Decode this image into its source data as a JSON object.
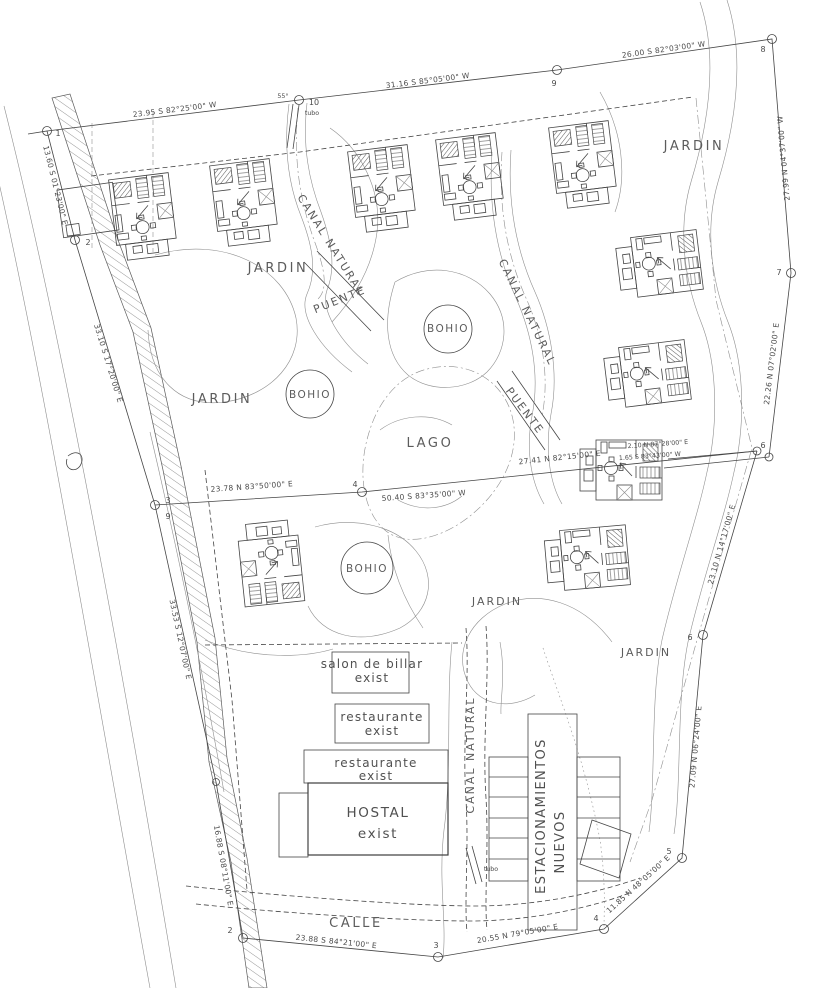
{
  "colors": {
    "background": "#ffffff",
    "line": "#454545",
    "text": "#4f4f4f"
  },
  "areas": {
    "jardin": "JARDIN",
    "bohio": "BOHIO",
    "lago": "LAGO",
    "puente": "PUENTE",
    "canal_natural": "CANAL NATURAL",
    "calle": "CALLE"
  },
  "buildings": {
    "salon": "salon de billar",
    "restaurante": "restaurante",
    "hostal": "HOSTAL",
    "exist": "exist",
    "estacionamientos": "ESTACIONAMIENTOS",
    "nuevos": "NUEVOS"
  },
  "survey": {
    "s1": "23.95 S 82°25'00\" W",
    "s2": "31.16 S 85°05'00\" W",
    "s3": "26.00 S 82°03'00\" W",
    "s4": "27.99 N 04°37'00\" W",
    "s5": "22.26 N 07°02'00\" E",
    "s6": "23.10 N 14°17'00\" E",
    "s7": "27.09 N 06°24'00\" E",
    "s8": "11.85 N 48°05'00\" E",
    "s9": "20.55 N 79°05'00\" E",
    "s10": "23.88 S 84°21'00\" E",
    "s11": "16.88 S 08°11'00\" E",
    "s12": "33.53 S 12°07'00\" E",
    "s13": "33.10 S 17°20'00\" E",
    "s14": "13.60 S 01°23'00\" E",
    "s15": "23.78 N 83°50'00\" E",
    "s16": "50.40 S 83°35'00\" W",
    "s17": "27.41 N 82°15'00\" E",
    "s18": "2.10 N 87°28'00\" E",
    "s19": "1.65 S 83°43'00\" W"
  },
  "markers": {
    "m1": "1",
    "m2": "2",
    "m3": "3",
    "m4": "4",
    "m5": "5",
    "m6": "6",
    "m7": "7",
    "m8": "8",
    "m9": "9",
    "m10": "10"
  },
  "annotations": {
    "tubo": "tubo",
    "angle_55": "55°"
  }
}
